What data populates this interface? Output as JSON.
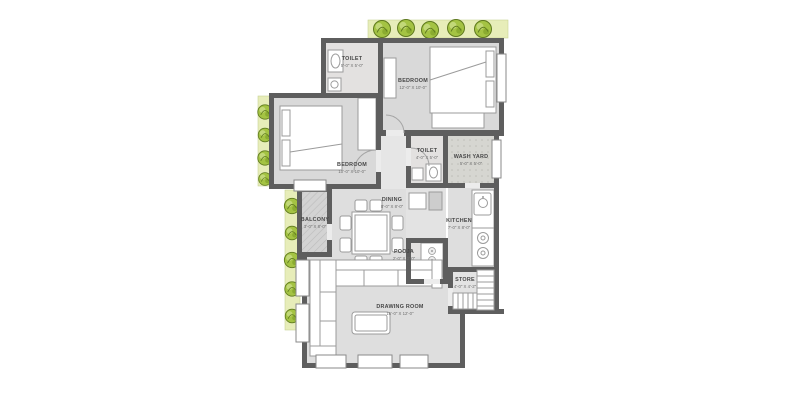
{
  "plan": {
    "type": "apartment-floor-plan",
    "rooms": {
      "toilet_top": {
        "name": "TOILET",
        "dim": "5'-0\" X 5'-0\""
      },
      "bedroom_top": {
        "name": "BEDROOM",
        "dim": "12'-0\" X 10'-0\""
      },
      "bedroom_left": {
        "name": "BEDROOM",
        "dim": "10'-0\" X 10'-0\""
      },
      "toilet_mid": {
        "name": "TOILET",
        "dim": "4'-0\" X 5'-0\""
      },
      "wash_yard": {
        "name": "WASH YARD",
        "dim": "5'-0\" X 5'-0\""
      },
      "dining": {
        "name": "DINING",
        "dim": "8'-0\" X 8'-0\""
      },
      "kitchen": {
        "name": "KITCHEN",
        "dim": "7'-0\" X 8'-0\""
      },
      "pooja": {
        "name": "POOJA",
        "dim": "2'-0\" X 3'-0\""
      },
      "balcony": {
        "name": "BALCONY",
        "dim": "3'-0\" X 8'-0\""
      },
      "drawing_room": {
        "name": "DRAWING ROOM",
        "dim": "15'-0\" X 12'-0\""
      },
      "store": {
        "name": "STORE",
        "dim": "4'-0\" X 4'-2\""
      }
    },
    "colors": {
      "wall": "#5e5e5e",
      "floor": "#d9d9d9",
      "floor_light": "#e6e6e6",
      "floor_tile": "#e3e1e0",
      "planter_bed": "#e7edb9",
      "tree": "#a4c343",
      "tree_outline": "#5f7a1e",
      "furniture_stroke": "#9b9b9b",
      "label_text": "#474747",
      "dim_text": "#6e6e6e"
    }
  }
}
